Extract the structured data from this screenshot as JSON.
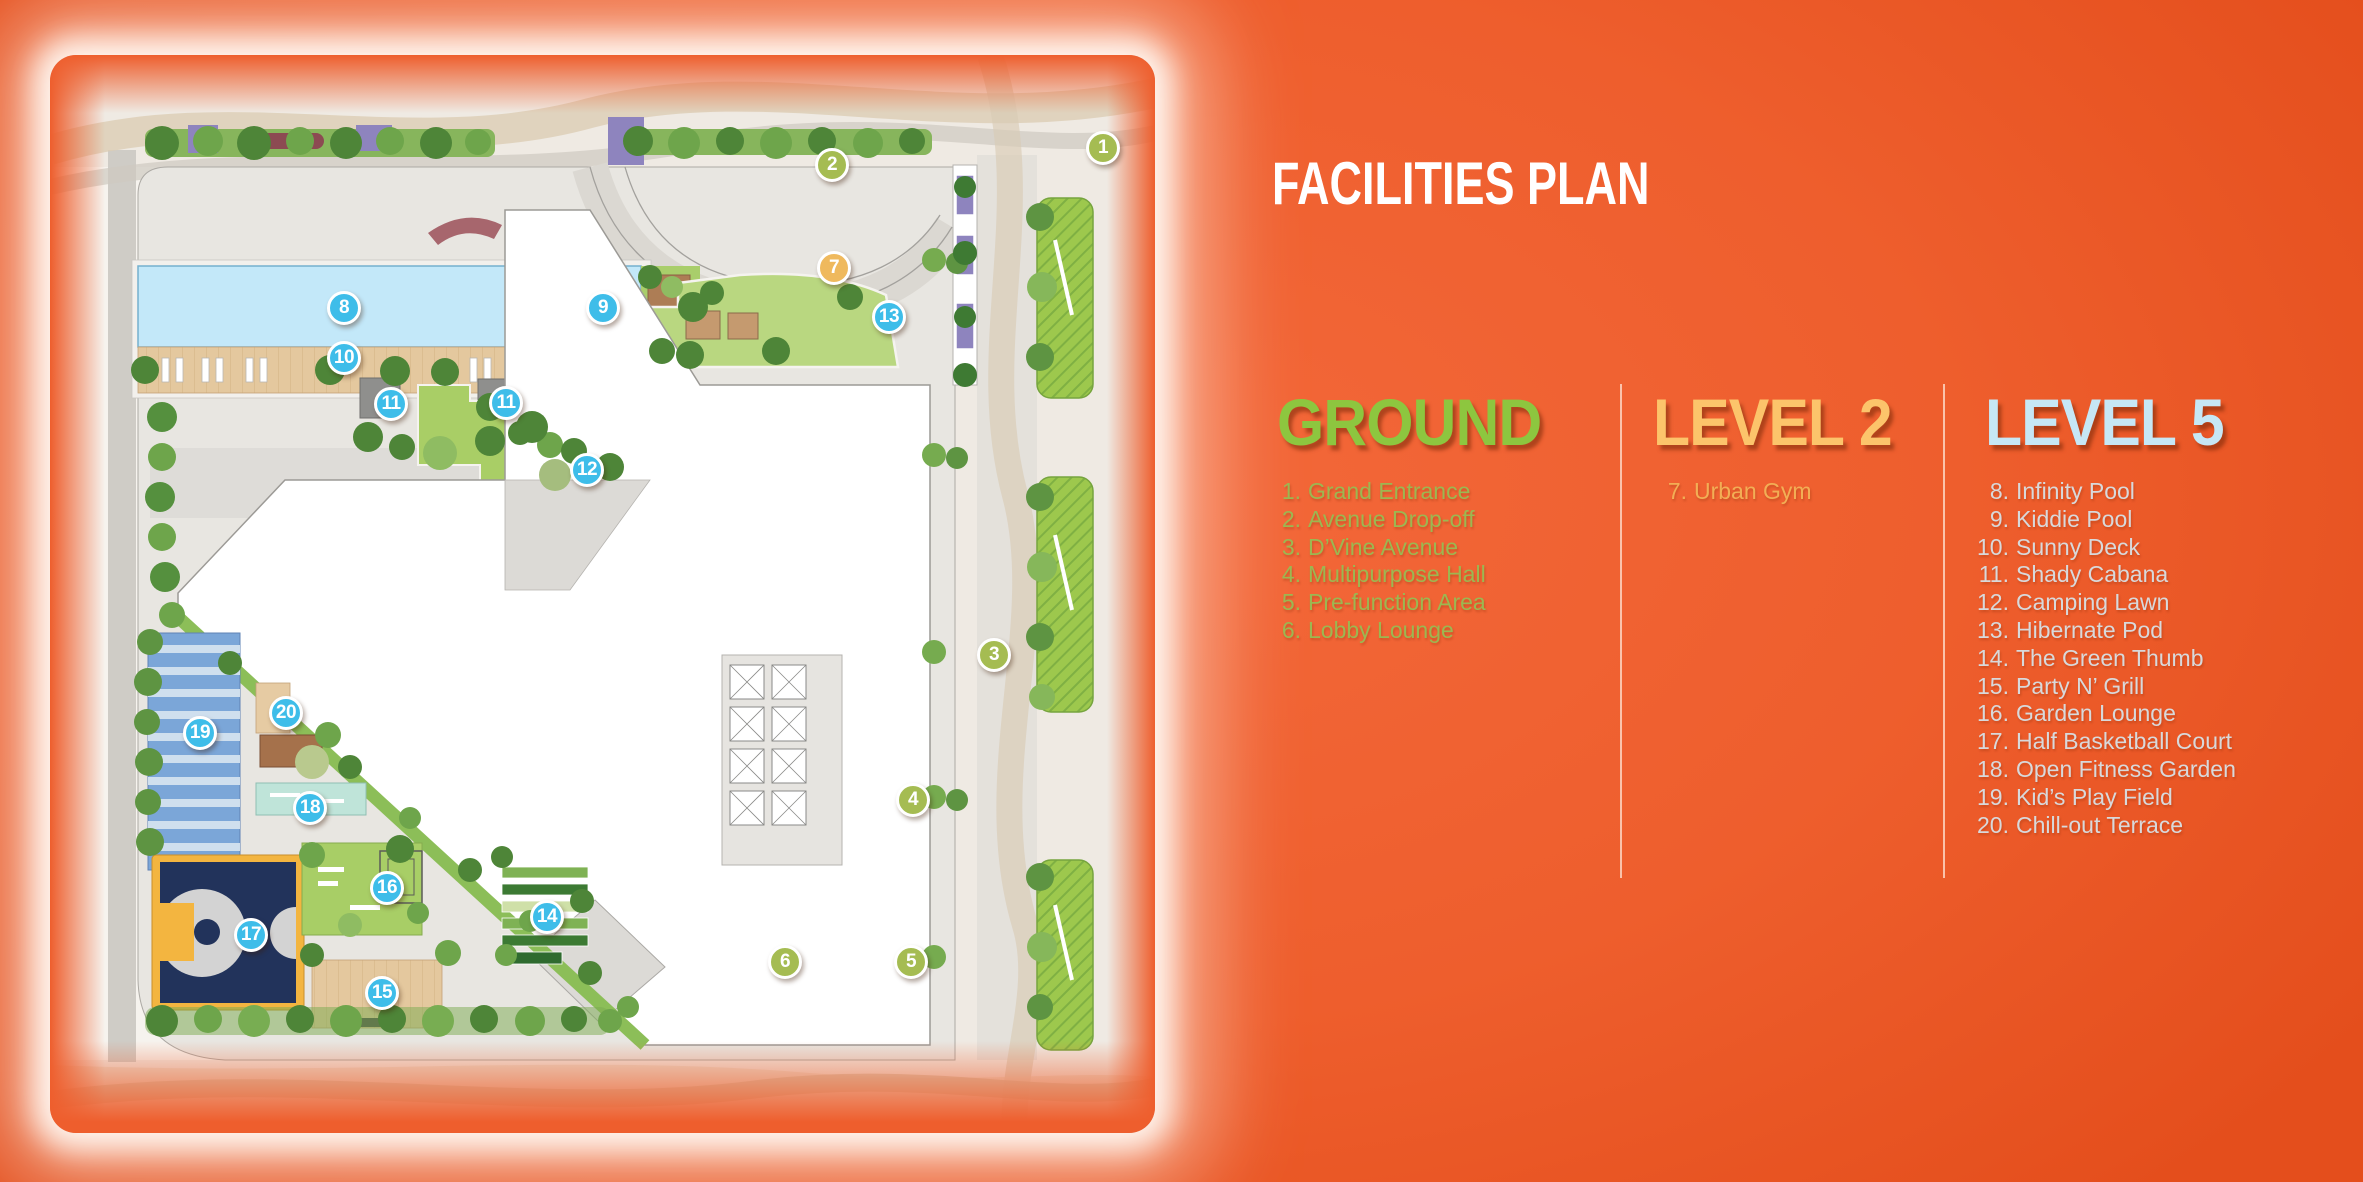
{
  "title": "FACILITIES PLAN",
  "colors": {
    "background": "#EE5E2D",
    "ground_title": "#8DC63F",
    "ground_item": "#9CB751",
    "level2_title": "#FCC46B",
    "level2_item": "#F2AE55",
    "level5_title": "#C6E7F5",
    "level5_item": "#D8D9DB",
    "marker_ground": "#A5BC52",
    "marker_level2": "#EFB95D",
    "marker_level5": "#3EBDE9"
  },
  "legend": {
    "columns": [
      {
        "id": "ground",
        "title": "GROUND",
        "items": [
          {
            "num": "1.",
            "label": "Grand Entrance"
          },
          {
            "num": "2.",
            "label": "Avenue Drop-off"
          },
          {
            "num": "3.",
            "label": "D’Vine Avenue"
          },
          {
            "num": "4.",
            "label": "Multipurpose Hall"
          },
          {
            "num": "5.",
            "label": "Pre-function Area"
          },
          {
            "num": "6.",
            "label": "Lobby Lounge"
          }
        ]
      },
      {
        "id": "level2",
        "title": "LEVEL 2",
        "items": [
          {
            "num": "7.",
            "label": "Urban Gym"
          }
        ]
      },
      {
        "id": "level5",
        "title": "LEVEL 5",
        "items": [
          {
            "num": "8.",
            "label": "Infinity Pool"
          },
          {
            "num": "9.",
            "label": "Kiddie Pool"
          },
          {
            "num": "10.",
            "label": "Sunny Deck"
          },
          {
            "num": "11.",
            "label": "Shady Cabana"
          },
          {
            "num": "12.",
            "label": "Camping Lawn"
          },
          {
            "num": "13.",
            "label": "Hibernate Pod"
          },
          {
            "num": "14.",
            "label": "The Green Thumb"
          },
          {
            "num": "15.",
            "label": "Party N’ Grill"
          },
          {
            "num": "16.",
            "label": "Garden Lounge"
          },
          {
            "num": "17.",
            "label": "Half Basketball Court"
          },
          {
            "num": "18.",
            "label": "Open Fitness Garden"
          },
          {
            "num": "19.",
            "label": "Kid’s Play Field"
          },
          {
            "num": "20.",
            "label": "Chill-out Terrace"
          }
        ]
      }
    ]
  },
  "map": {
    "markers": [
      {
        "num": "1",
        "level": "ground",
        "x": 1053,
        "y": 93
      },
      {
        "num": "2",
        "level": "ground",
        "x": 782,
        "y": 110
      },
      {
        "num": "3",
        "level": "ground",
        "x": 944,
        "y": 600
      },
      {
        "num": "4",
        "level": "ground",
        "x": 863,
        "y": 745
      },
      {
        "num": "5",
        "level": "ground",
        "x": 861,
        "y": 907
      },
      {
        "num": "6",
        "level": "ground",
        "x": 735,
        "y": 907
      },
      {
        "num": "7",
        "level": "level2",
        "x": 784,
        "y": 213
      },
      {
        "num": "8",
        "level": "level5",
        "x": 294,
        "y": 253
      },
      {
        "num": "9",
        "level": "level5",
        "x": 553,
        "y": 253
      },
      {
        "num": "10",
        "level": "level5",
        "x": 294,
        "y": 303
      },
      {
        "num": "11",
        "level": "level5",
        "x": 341,
        "y": 349
      },
      {
        "num": "11",
        "level": "level5",
        "x": 456,
        "y": 348
      },
      {
        "num": "12",
        "level": "level5",
        "x": 537,
        "y": 415
      },
      {
        "num": "13",
        "level": "level5",
        "x": 839,
        "y": 262
      },
      {
        "num": "14",
        "level": "level5",
        "x": 497,
        "y": 862
      },
      {
        "num": "15",
        "level": "level5",
        "x": 332,
        "y": 938
      },
      {
        "num": "16",
        "level": "level5",
        "x": 337,
        "y": 833
      },
      {
        "num": "17",
        "level": "level5",
        "x": 201,
        "y": 880
      },
      {
        "num": "18",
        "level": "level5",
        "x": 260,
        "y": 753
      },
      {
        "num": "19",
        "level": "level5",
        "x": 150,
        "y": 678
      },
      {
        "num": "20",
        "level": "level5",
        "x": 236,
        "y": 658
      }
    ]
  }
}
